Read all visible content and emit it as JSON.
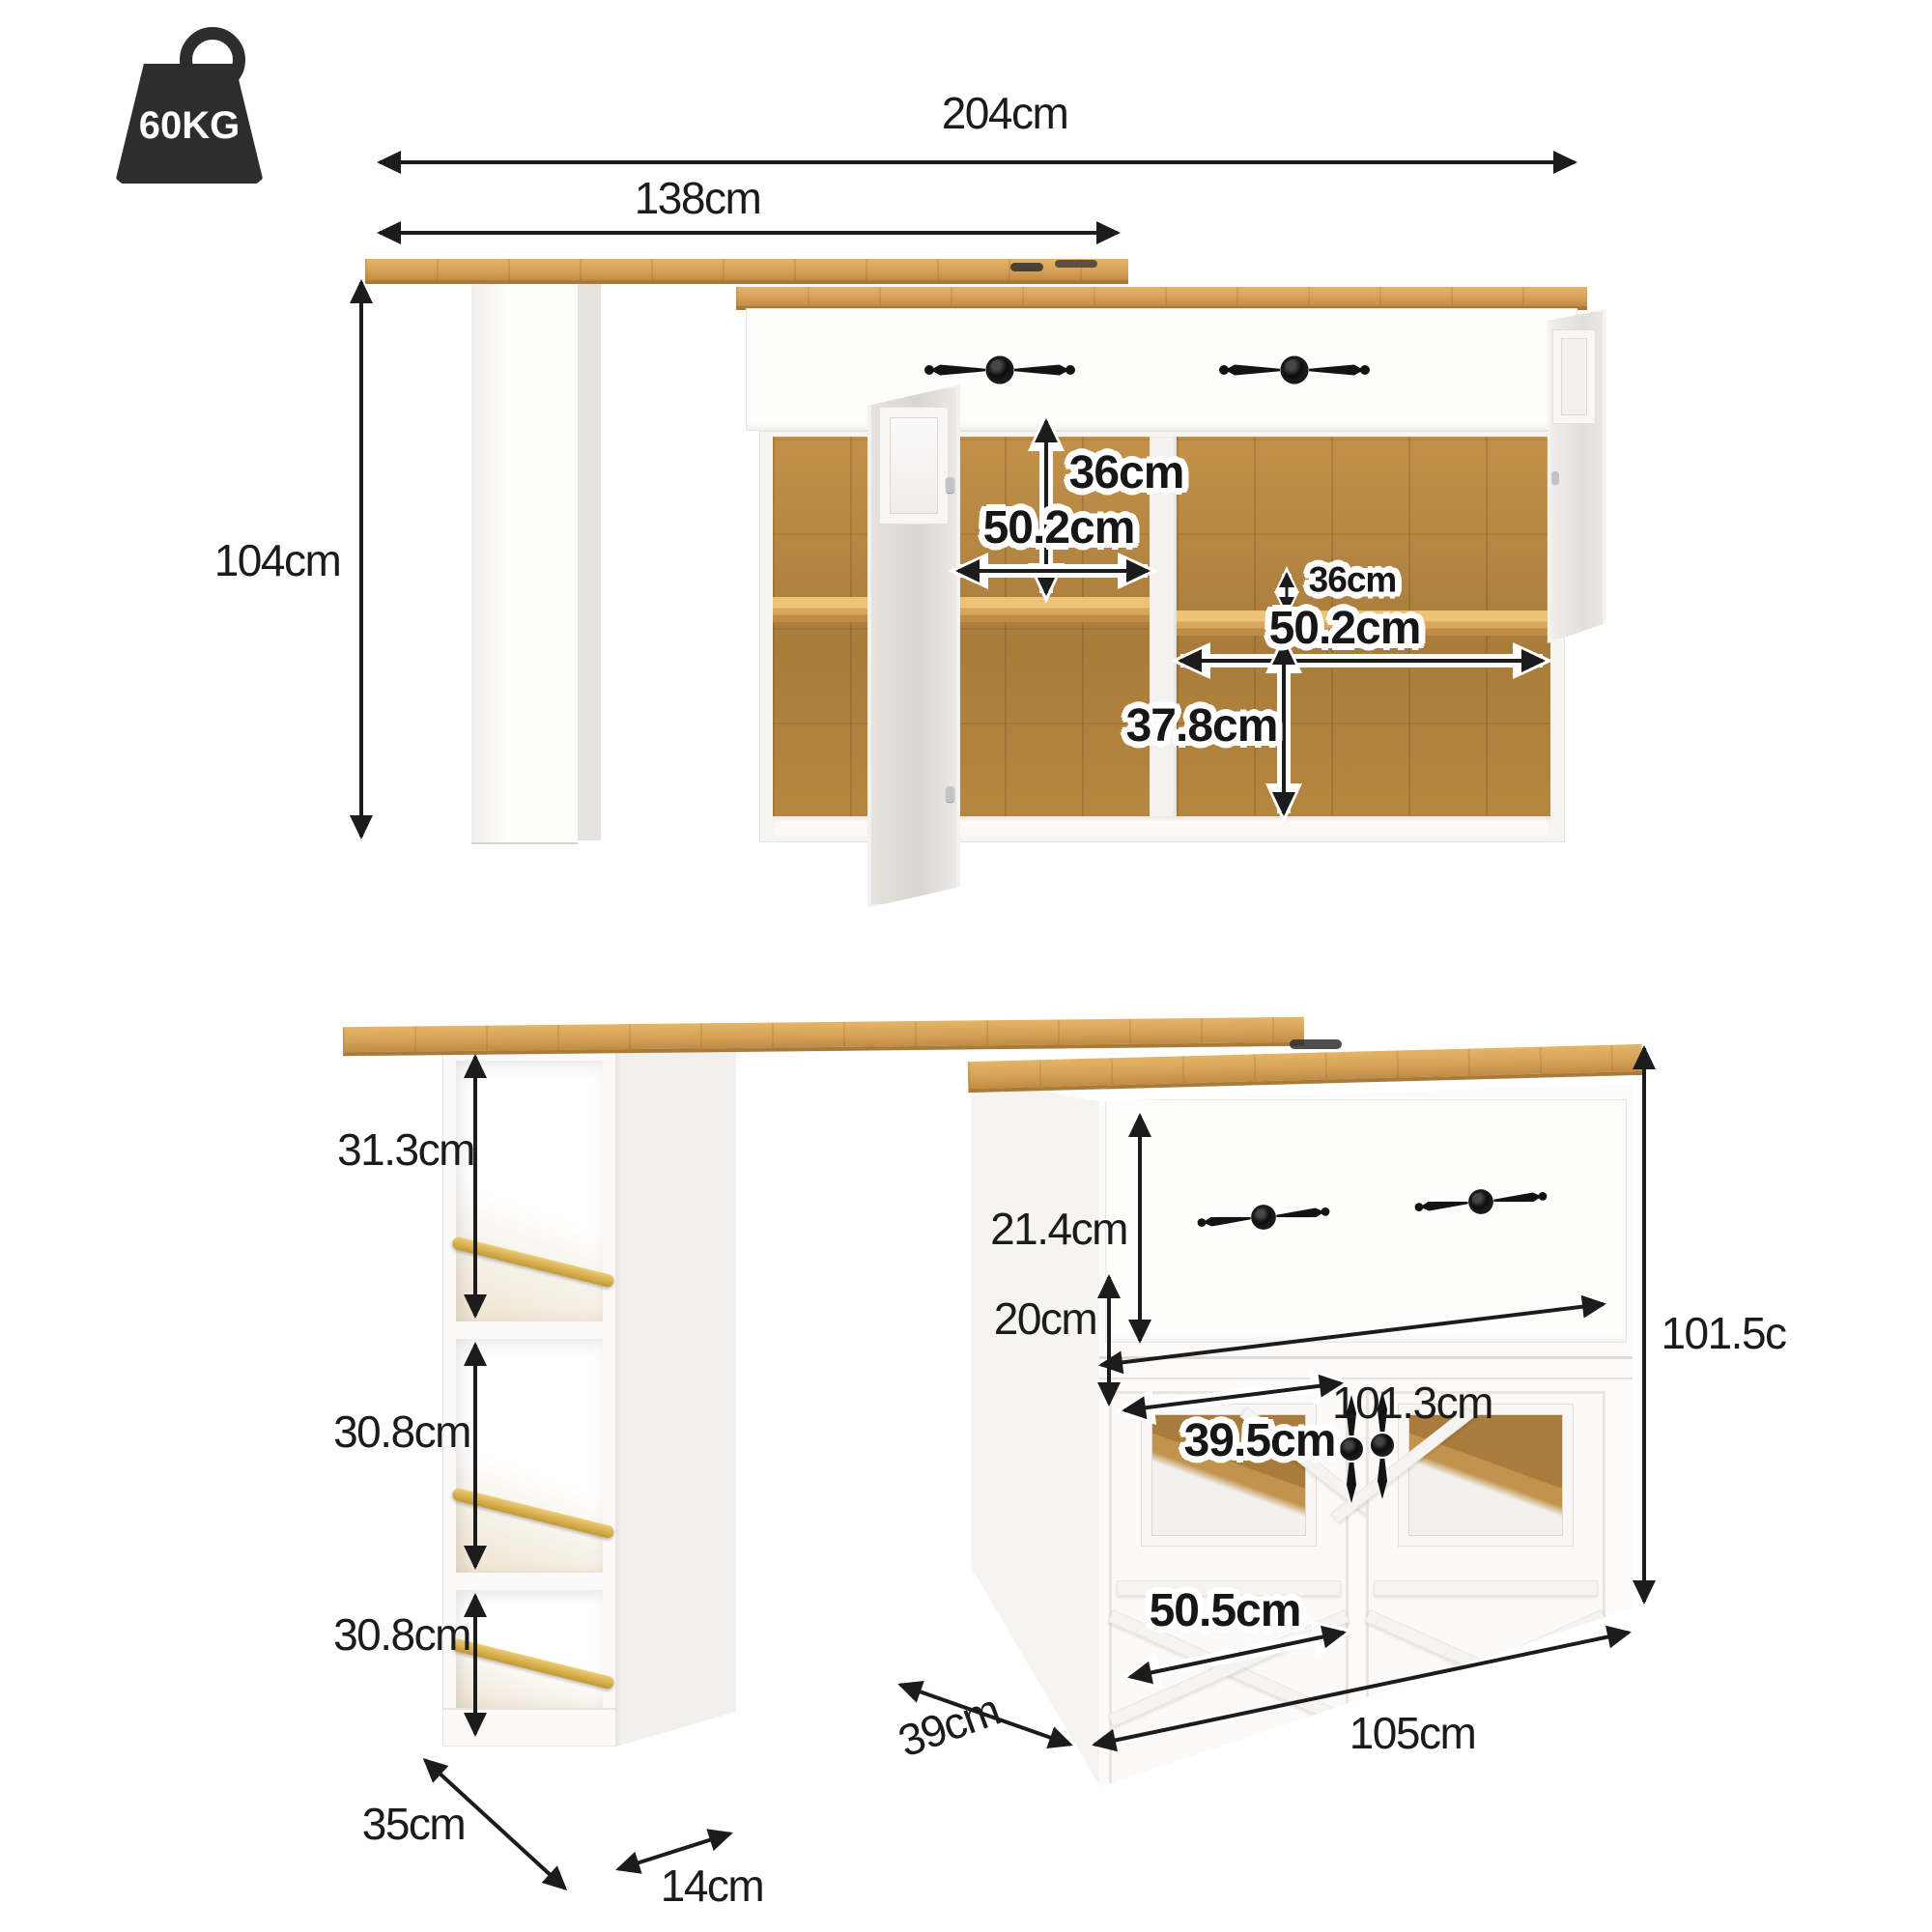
{
  "badge": {
    "max_load": "60KG"
  },
  "top_view": {
    "width_total": "204cm",
    "width_table": "138cm",
    "height_total": "104cm",
    "compartment_height": "36cm",
    "compartment_width_left": "50.2cm",
    "shelf_spacing": "36cm",
    "compartment_width_right": "50.2cm",
    "compartment_height_lower": "37.8cm"
  },
  "bottom_view": {
    "shelf_1_height": "31.3cm",
    "shelf_2_height": "30.8cm",
    "shelf_3_height": "30.8cm",
    "column_depth": "35cm",
    "column_width": "14cm",
    "drawer_height": "21.4cm",
    "inner_width": "101.3cm",
    "window_height": "20cm",
    "window_width": "39.5cm",
    "door_width": "50.5cm",
    "cabinet_width": "105cm",
    "cabinet_depth": "39cm",
    "cabinet_height": "101.5c"
  }
}
